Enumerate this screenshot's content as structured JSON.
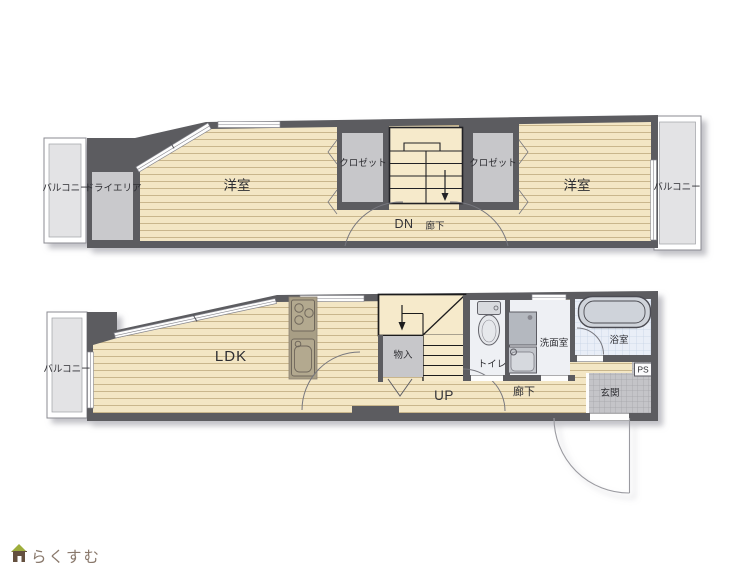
{
  "floor2": {
    "balcony_left": "バルコニー",
    "dry_area": "ドライエリア",
    "room_left": "洋室",
    "closet_left": "クロゼット",
    "stairs": "DN",
    "hallway": "廊下",
    "closet_right": "クロゼット",
    "room_right": "洋室",
    "balcony_right": "バルコニー"
  },
  "floor1": {
    "balcony": "バルコニー",
    "ldk": "LDK",
    "storage": "物入",
    "stairs": "UP",
    "toilet": "トイレ",
    "washroom": "洗面室",
    "bathroom": "浴室",
    "hallway": "廊下",
    "entrance": "玄関",
    "pipe_space": "PS"
  },
  "logo": {
    "text": "らくすむ"
  },
  "colors": {
    "wall": "#5b5c60",
    "wood_floor": "#f3e6c4",
    "plank_line": "#c9b68c",
    "stair_floor": "#f6eacb",
    "closet_gray": "#c7c7ca",
    "balcony_gray": "#e3e3e5",
    "white_room": "#eef0f4",
    "bath_tile": "#e9eef7",
    "entrance_tile": "#c4c4c8",
    "kitchen_counter": "#a89e85",
    "fixture_gray": "#b4b8bf",
    "logo_green": "#9eae3c",
    "logo_brown": "#64503f",
    "logo_text": "#8a796c"
  }
}
